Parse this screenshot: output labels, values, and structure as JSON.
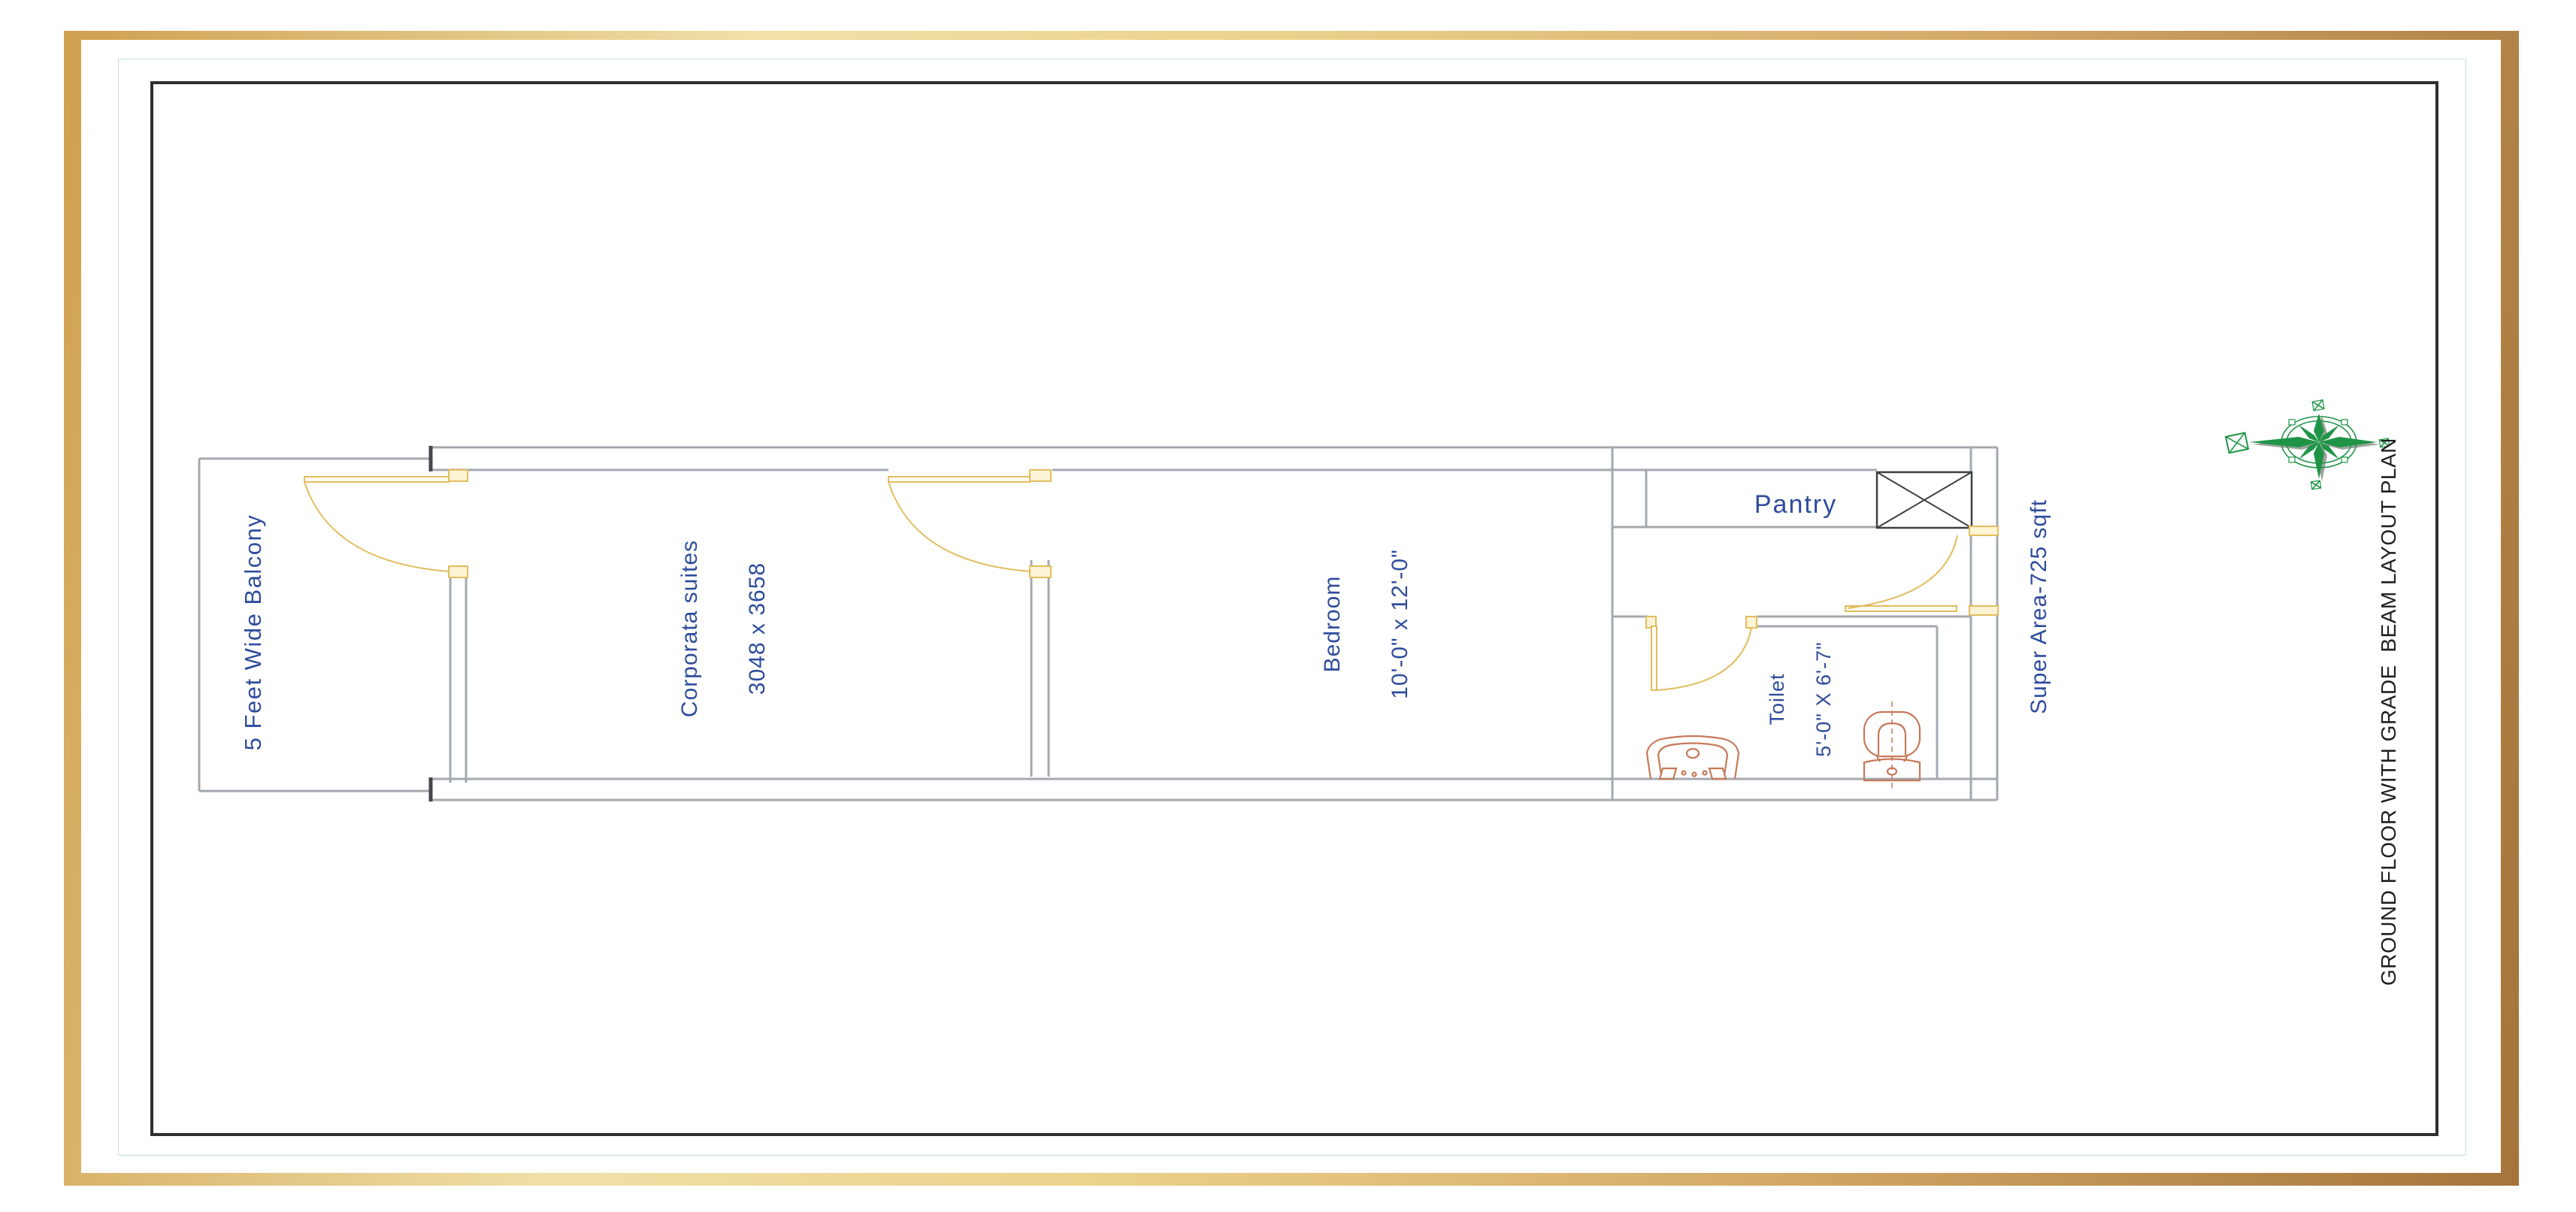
{
  "title": {
    "text": "GROUND FLOOR WITH GRADE  BEAM LAYOUT PLAN"
  },
  "rooms": {
    "balcony": {
      "label": "5 Feet Wide Balcony"
    },
    "suite": {
      "label": "Corporata suites",
      "dimensions": "3048 x 3658"
    },
    "bedroom": {
      "label": "Bedroom",
      "dimensions": "10'-0\" x 12'-0\""
    },
    "pantry": {
      "label": "Pantry"
    },
    "toilet": {
      "label": "Toilet",
      "dimensions": "5'-0\" X 6'-7\""
    },
    "super_area": {
      "label": "Super Area-725 sqft"
    }
  },
  "colors": {
    "wall": "#a3a9af",
    "wall_dark": "#46464c",
    "door": "#e2bd5e",
    "door_fill": "#fdf4d5",
    "fixture": "#c6795a",
    "text_blue": "#2e4c9c",
    "title_color": "#1f1f1f",
    "compass": "#1f9447",
    "compass_shadow": "#9ba39b",
    "teal": "#c2e2d6",
    "frame_black": "#2e2e31"
  }
}
